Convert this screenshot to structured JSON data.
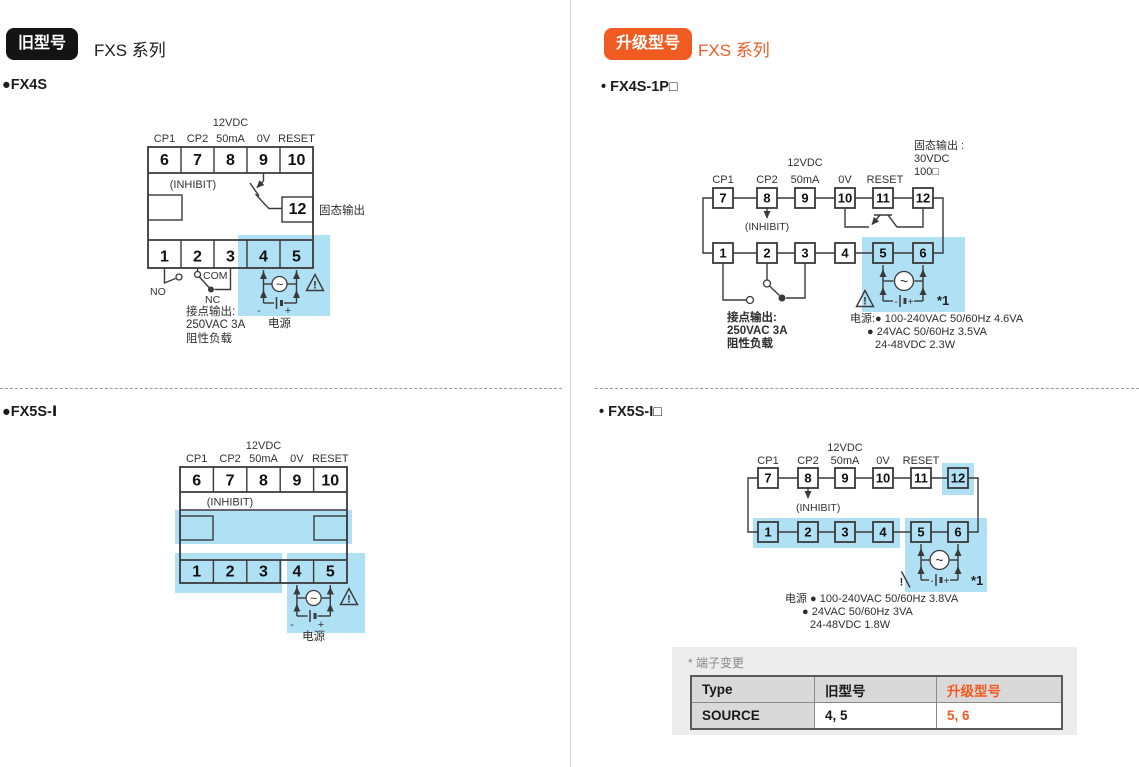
{
  "colors": {
    "accent_orange": "#f05b22",
    "highlight_blue": "#b0e0f4",
    "line": "#3a3a3a",
    "badge_black": "#141414"
  },
  "left_column": {
    "badge": "旧型号",
    "series": "FXS 系列",
    "fx4s": {
      "title": "●FX4S",
      "rating": "12VDC",
      "signals": [
        "CP1",
        "CP2",
        "50mA",
        "0V",
        "RESET"
      ],
      "top_terminals": [
        "6",
        "7",
        "8",
        "9",
        "10"
      ],
      "inhibit": "(INHIBIT)",
      "ssr_terminal": "12",
      "ssr_label": "固态输出",
      "bottom_terminals": [
        "1",
        "2",
        "3",
        "4",
        "5"
      ],
      "no_label": "NO",
      "com_label": "COM",
      "nc_label": "NC",
      "contact_lines": [
        "接点输出:",
        "250VAC 3A",
        "阻性负载"
      ],
      "ac_mark": "~",
      "warn_mark": "!",
      "minus": "-",
      "plus": "+",
      "power_label": "电源"
    },
    "fx5s": {
      "title": "●FX5S-Ⅰ",
      "rating": "12VDC",
      "signals": [
        "CP1",
        "CP2",
        "50mA",
        "0V",
        "RESET"
      ],
      "top_terminals": [
        "6",
        "7",
        "8",
        "9",
        "10"
      ],
      "inhibit": "(INHIBIT)",
      "bottom_terminals": [
        "1",
        "2",
        "3",
        "4",
        "5"
      ],
      "ac_mark": "~",
      "warn_mark": "!",
      "minus": "-",
      "plus": "+",
      "power_label": "电源"
    }
  },
  "right_column": {
    "badge": "升级型号",
    "series": "FXS 系列",
    "fx4s1p": {
      "title": "• FX4S-1P□",
      "rating": "12VDC",
      "signals": [
        "CP1",
        "CP2",
        "50mA",
        "0V",
        "RESET"
      ],
      "ssr_lines": [
        "固态输出 :",
        "30VDC",
        "100□"
      ],
      "top_terminals": [
        "7",
        "8",
        "9",
        "10",
        "11",
        "12"
      ],
      "inhibit": "(INHIBIT)",
      "bottom_terminals": [
        "1",
        "2",
        "3",
        "4",
        "5",
        "6"
      ],
      "contact_lines": [
        "接点输出:",
        "250VAC 3A",
        "阻性负载"
      ],
      "ac_mark": "~",
      "warn_mark": "!",
      "minus": "-",
      "plus": "+",
      "note": "*1",
      "power_lines": [
        "电源:● 100-240VAC 50/60Hz 4.6VA",
        "● 24VAC 50/60Hz 3.5VA",
        "24-48VDC 2.3W"
      ]
    },
    "fx5si": {
      "title": "• FX5S-I□",
      "rating": "12VDC",
      "signals": [
        "CP1",
        "CP2",
        "50mA",
        "0V",
        "RESET"
      ],
      "top_terminals": [
        "7",
        "8",
        "9",
        "10",
        "11",
        "12"
      ],
      "inhibit": "(INHIBIT)",
      "bottom_terminals": [
        "1",
        "2",
        "3",
        "4",
        "5",
        "6"
      ],
      "ac_mark": "~",
      "warn_mark": "!",
      "minus": "-",
      "plus": "+",
      "note": "*1",
      "power_lines": [
        "电源 ● 100-240VAC 50/60Hz 3.8VA",
        "● 24VAC 50/60Hz 3VA",
        "24-48VDC 1.8W"
      ]
    },
    "table": {
      "caption": "* 端子变更",
      "headers": [
        "Type",
        "旧型号",
        "升级型号"
      ],
      "rows": [
        [
          "SOURCE",
          "4, 5",
          "5, 6"
        ]
      ]
    }
  }
}
